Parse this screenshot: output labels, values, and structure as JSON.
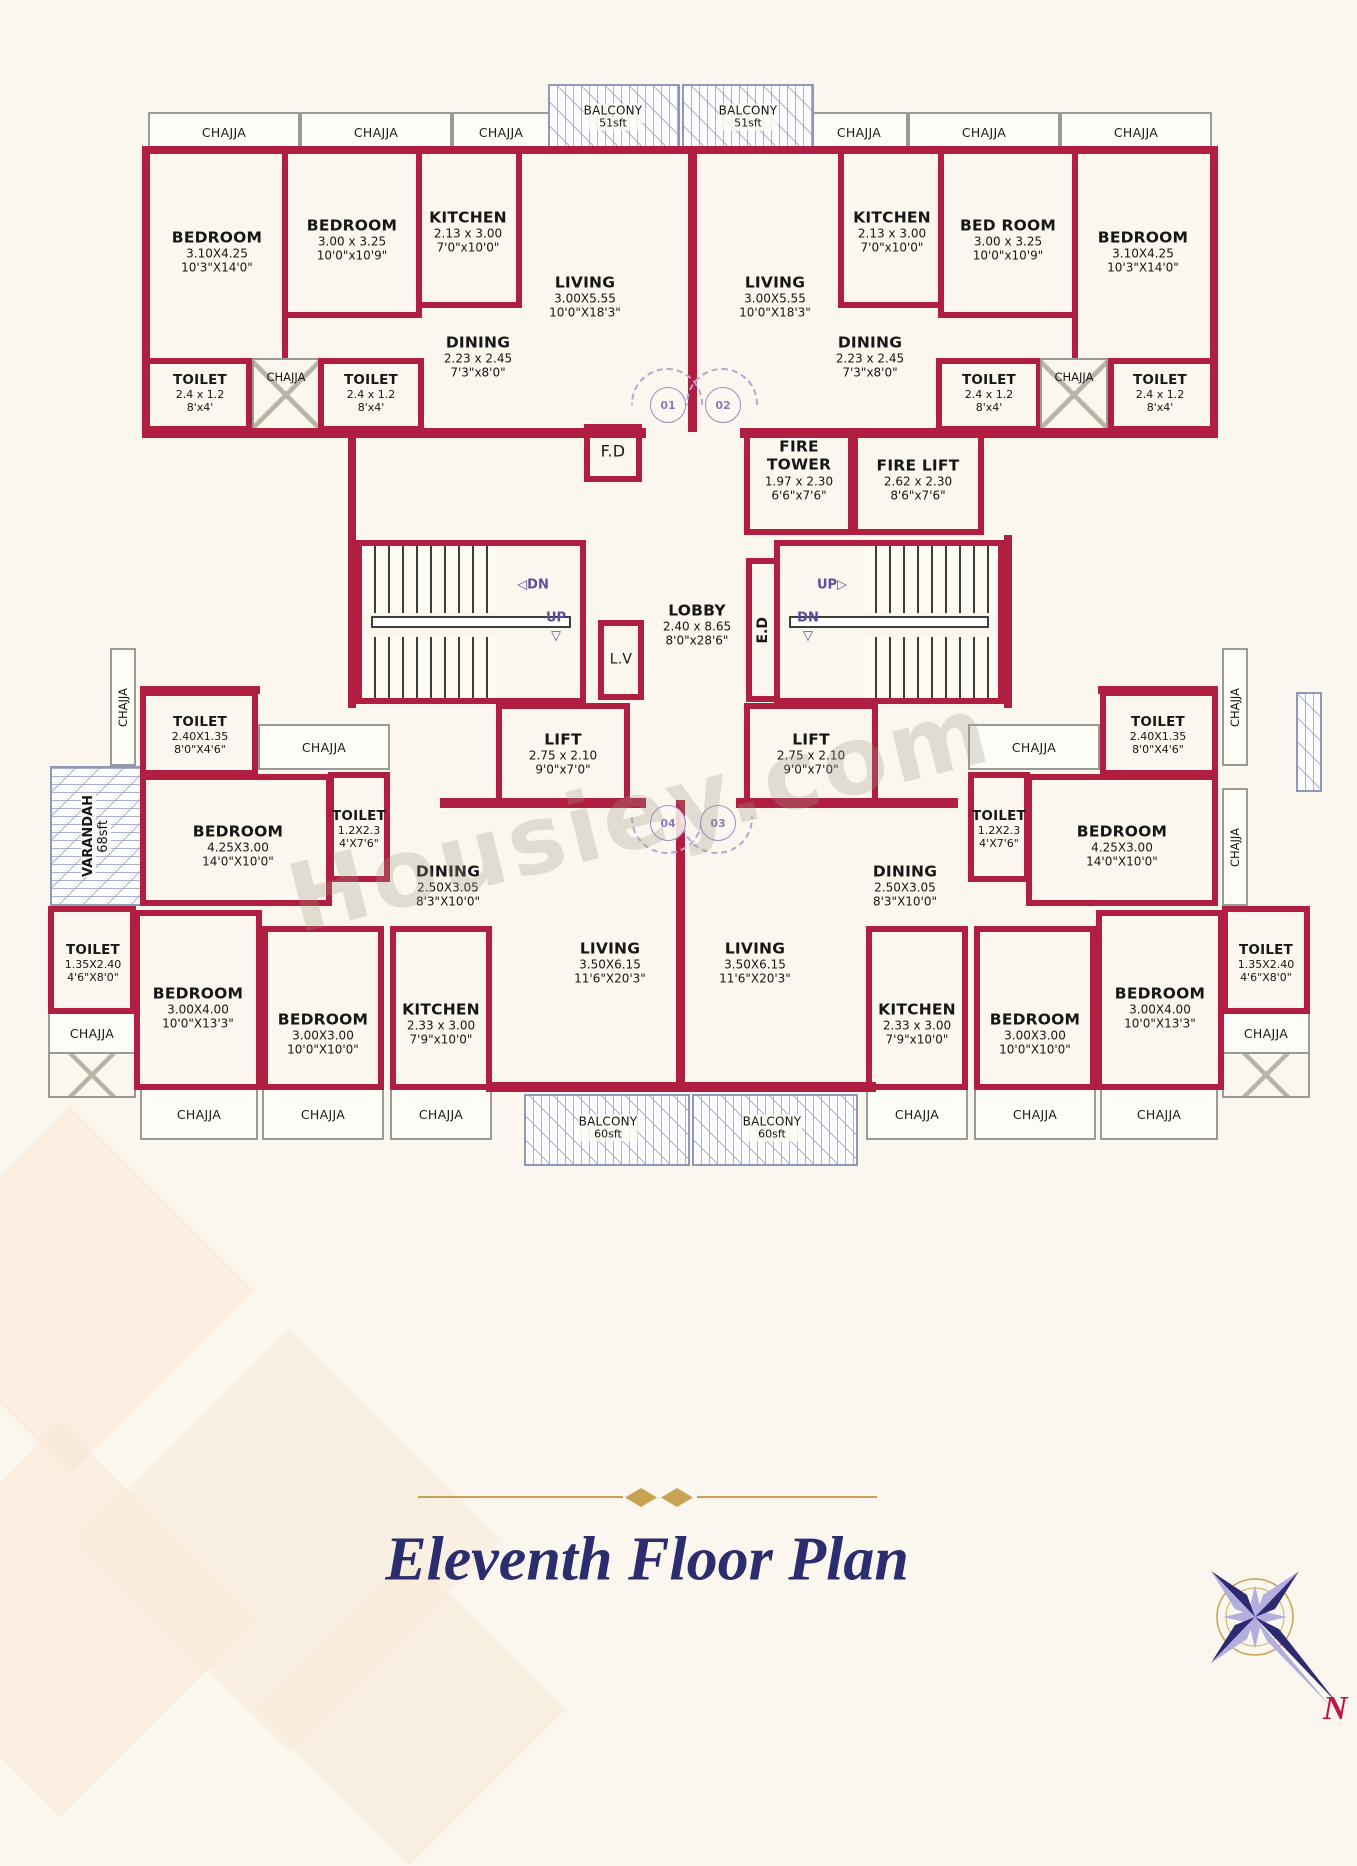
{
  "title": "Eleventh Floor Plan",
  "watermark": "Housiey.com",
  "compass": {
    "north_label": "N"
  },
  "labels": {
    "chajja": "CHAJJA",
    "fd": "F.D",
    "lv": "L.V",
    "ed": "E.D",
    "up": "UP",
    "dn": "DN"
  },
  "icons": {
    "arrow_left": "◁",
    "arrow_right": "▷",
    "arrow_down": "▽"
  },
  "doors": {
    "d01": "01",
    "d02": "02",
    "d03": "03",
    "d04": "04"
  },
  "balcony_top": {
    "name": "BALCONY",
    "area": "51sft"
  },
  "balcony_bottom": {
    "name": "BALCONY",
    "area": "60sft"
  },
  "varandah": {
    "name": "VARANDAH",
    "area": "68sft"
  },
  "core": {
    "fire_tower": {
      "name": "FIRE TOWER",
      "m": "1.97 x 2.30",
      "ft": "6'6\"x7'6\""
    },
    "fire_lift": {
      "name": "FIRE LIFT",
      "m": "2.62 x 2.30",
      "ft": "8'6\"x7'6\""
    },
    "lobby": {
      "name": "LOBBY",
      "m": "2.40 x 8.65",
      "ft": "8'0\"x28'6\""
    },
    "lift": {
      "name": "LIFT",
      "m": "2.75 x 2.10",
      "ft": "9'0\"x7'0\""
    }
  },
  "top_wing": {
    "bedroom_corner": {
      "name": "BEDROOM",
      "m": "3.10X4.25",
      "ft": "10'3\"X14'0\""
    },
    "bedroom_mid_left": {
      "name": "BEDROOM",
      "m": "3.00 x 3.25",
      "ft": "10'0\"x10'9\""
    },
    "bedroom_mid_right": {
      "name": "BED ROOM",
      "m": "3.00 x 3.25",
      "ft": "10'0\"x10'9\""
    },
    "kitchen": {
      "name": "KITCHEN",
      "m": "2.13 x 3.00",
      "ft": "7'0\"x10'0\""
    },
    "living": {
      "name": "LIVING",
      "m": "3.00X5.55",
      "ft": "10'0\"X18'3\""
    },
    "dining": {
      "name": "DINING",
      "m": "2.23 x 2.45",
      "ft": "7'3\"x8'0\""
    },
    "toilet": {
      "name": "TOILET",
      "m": "2.4 x 1.2",
      "ft": "8'x4'"
    }
  },
  "bottom_wing": {
    "toilet_attached": {
      "name": "TOILET",
      "m": "2.40X1.35",
      "ft": "8'0\"X4'6\""
    },
    "toilet_common": {
      "name": "TOILET",
      "m": "1.2X2.3",
      "ft": "4'X7'6\""
    },
    "toilet_corner": {
      "name": "TOILET",
      "m": "1.35X2.40",
      "ft": "4'6\"X8'0\""
    },
    "bedroom_master": {
      "name": "BEDROOM",
      "m": "4.25X3.00",
      "ft": "14'0\"X10'0\""
    },
    "bedroom_large": {
      "name": "BEDROOM",
      "m": "3.00X4.00",
      "ft": "10'0\"X13'3\""
    },
    "bedroom_small": {
      "name": "BEDROOM",
      "m": "3.00X3.00",
      "ft": "10'0\"X10'0\""
    },
    "kitchen": {
      "name": "KITCHEN",
      "m": "2.33 x 3.00",
      "ft": "7'9\"x10'0\""
    },
    "dining": {
      "name": "DINING",
      "m": "2.50X3.05",
      "ft": "8'3\"X10'0\""
    },
    "living": {
      "name": "LIVING",
      "m": "3.50X6.15",
      "ft": "11'6\"X20'3\""
    }
  },
  "colors": {
    "wall": "#b01e41",
    "background": "#fbf7ee",
    "gold": "#c9a254",
    "title_navy": "#2b2d6e",
    "accent_purple": "#5b4f9e",
    "north_red": "#c2134b"
  }
}
